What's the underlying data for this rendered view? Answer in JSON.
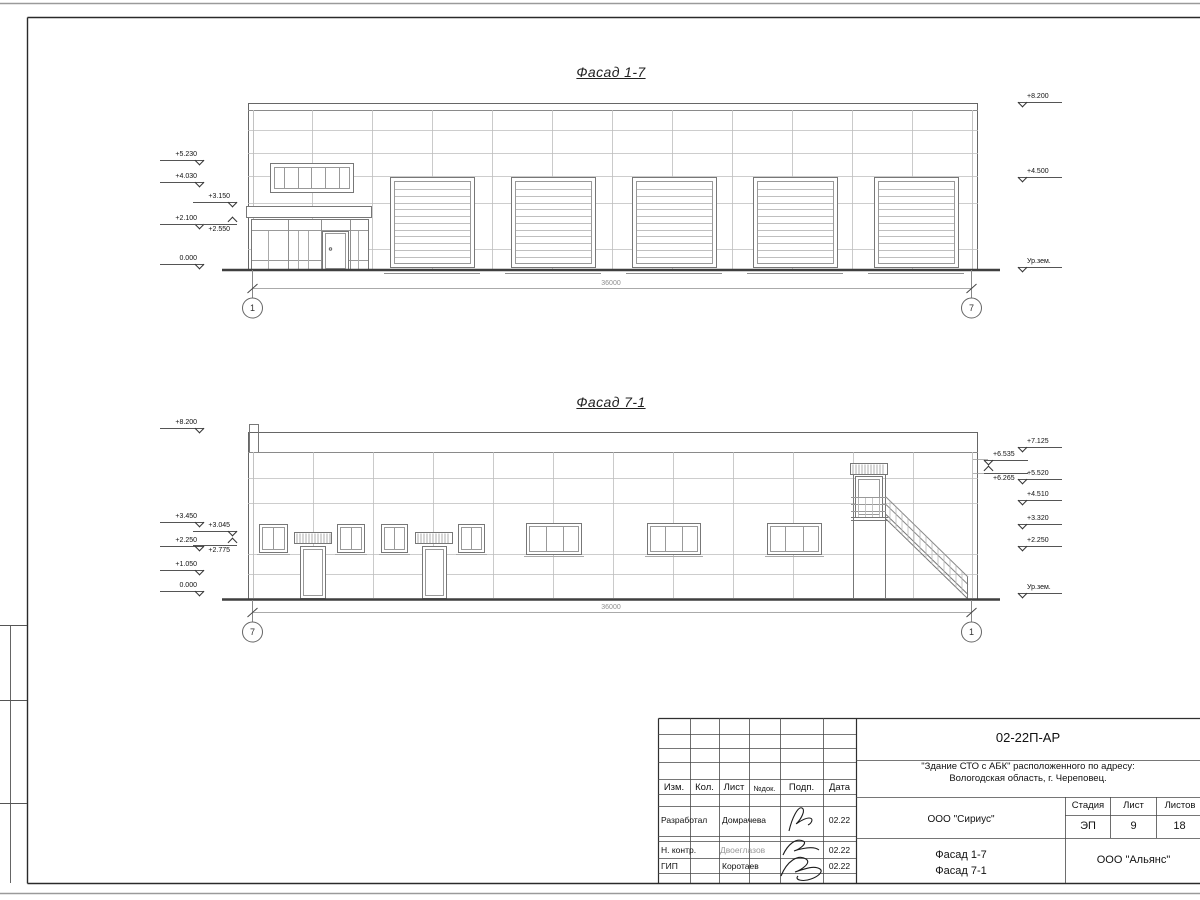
{
  "f17": {
    "title": "Фасад 1-7",
    "dim": "36000",
    "axL": "1",
    "axR": "7",
    "mL": [
      "+5.230",
      "+4.030",
      "+3.150",
      "+2.100",
      "+2.550",
      "0.000"
    ],
    "mR": [
      "+8.200",
      "+4.500",
      "Ур.зем."
    ]
  },
  "f71": {
    "title": "Фасад 7-1",
    "dim": "36000",
    "axL": "7",
    "axR": "1",
    "mL": [
      "+8.200",
      "+3.450",
      "+3.045",
      "+2.250",
      "+2.775",
      "+1.050",
      "0.000"
    ],
    "mR": [
      "+7.125",
      "+6.535",
      "+6.265",
      "+5.520",
      "+4.510",
      "+3.320",
      "+2.250",
      "Ур.зем."
    ]
  },
  "tb": {
    "code": "02-22П-АР",
    "project_line1": "\"Здание СТО с АБК\" расположенного по адресу:",
    "project_line2": "Вологодская область, г. Череповец.",
    "designer_org": "ООО \"Сириус\"",
    "drawing_line1": "Фасад 1-7",
    "drawing_line2": "Фасад 7-1",
    "contractor": "ООО \"Альянс\"",
    "stage_label": "Стадия",
    "sheet_label": "Лист",
    "sheets_label": "Листов",
    "stage": "ЭП",
    "sheet_no": "9",
    "sheets_total": "18",
    "col_izm": "Изм.",
    "col_kol": "Кол.",
    "col_list": "Лист",
    "col_doc": "№док.",
    "col_sign": "Подп.",
    "col_date": "Дата",
    "row1_role": "Разработал",
    "row1_name": "Домрачева",
    "row1_date": "02.22",
    "row2_role": "Н. контр.",
    "row2_name": "Двоеглазов",
    "row2_date": "02.22",
    "row3_role": "ГИП",
    "row3_name": "Коротаев",
    "row3_date": "02.22"
  }
}
